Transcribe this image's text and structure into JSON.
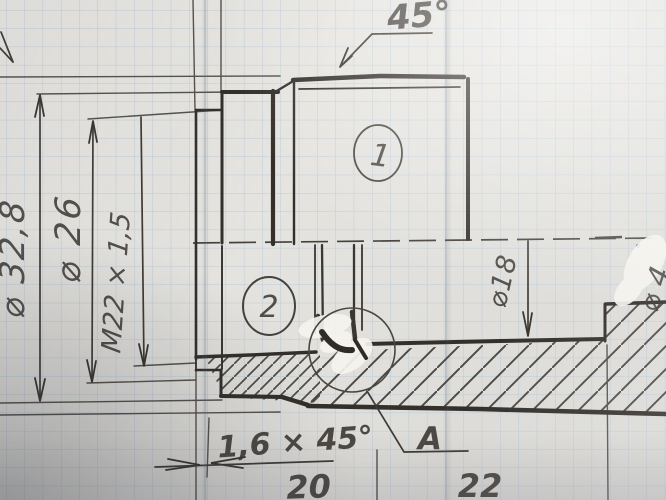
{
  "palette": {
    "pencil": "#38342f",
    "pencil_dark": "#2d2a26",
    "grid_blue": "#a6bfd4",
    "paper": "#e3e2de",
    "whiteout": "#f5f3ee"
  },
  "drawing": {
    "callouts": {
      "top_chamfer": "45°",
      "bottom_chamfer": "1,6 × 45°",
      "detail": "A",
      "partial_right": "⌀ 4"
    },
    "dimensions": {
      "outer_dia": "⌀ 32,8",
      "mid_dia": "⌀ 26",
      "thread": "M22 × 1,5",
      "bore_dia": "⌀18",
      "length_left": "20",
      "length_right": "22"
    },
    "balloons": {
      "one": "1",
      "two": "2"
    }
  }
}
